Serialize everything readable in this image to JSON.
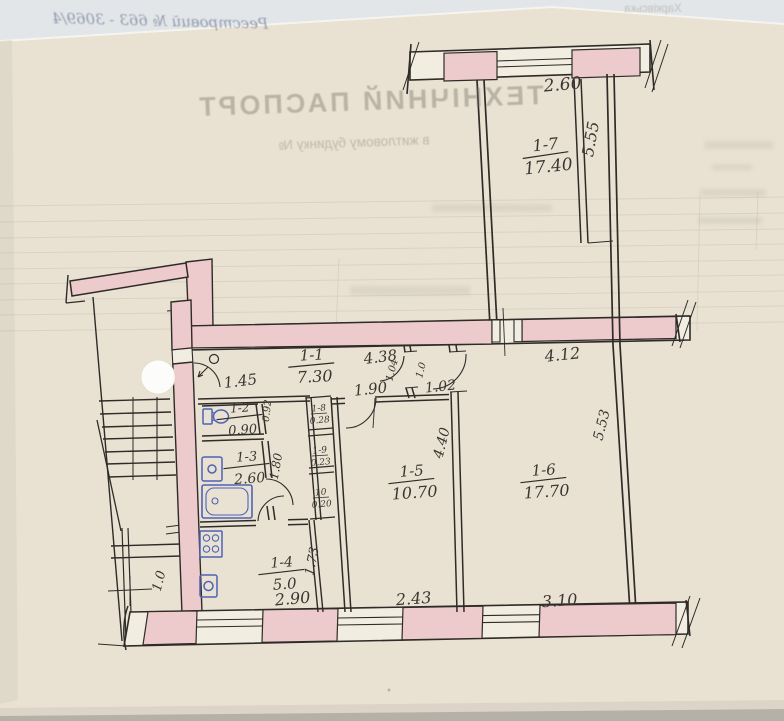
{
  "bleedthrough": {
    "registry_line": "Реєстровий № 663 - 3069/4",
    "region_note": "Харківська",
    "title": "ТЕХНІЧНИЙ ПАСПОРТ",
    "subtitle": "в житловому будинку №"
  },
  "colors": {
    "paper": "#e9e2d2",
    "photo_top_strip": "#e2e6e8",
    "photo_bottom_strip": "#b6b1a8",
    "wall_pink": "#edcacb",
    "wall_white": "#f1ede1",
    "ink": "#2e2b28",
    "plumbing_blue": "#4f63b5",
    "bleed_gray": "#a49d8f"
  },
  "plan": {
    "rooms": [
      {
        "number": "1-1",
        "area": "7.30",
        "x": 312,
        "y": 360,
        "rot": -3,
        "size": 15
      },
      {
        "number": "1-2",
        "area": "0.90",
        "x": 240,
        "y": 412,
        "rot": -4,
        "size": 12
      },
      {
        "number": "1-3",
        "area": "2.60",
        "x": 247,
        "y": 461,
        "rot": -4,
        "size": 13
      },
      {
        "number": "1-4",
        "area": "5.0",
        "x": 282,
        "y": 567,
        "rot": -4,
        "size": 14
      },
      {
        "number": "1-5",
        "area": "10.70",
        "x": 412,
        "y": 476,
        "rot": -4,
        "size": 15
      },
      {
        "number": "1-6",
        "area": "17.70",
        "x": 544,
        "y": 475,
        "rot": -4,
        "size": 15
      },
      {
        "number": "1-7",
        "area": "17.40",
        "x": 546,
        "y": 150,
        "rot": -6,
        "size": 16
      }
    ],
    "dimensions": [
      {
        "text": "2.60",
        "x": 563,
        "y": 90,
        "rot": -5,
        "size": 17
      },
      {
        "text": "5.55",
        "x": 596,
        "y": 140,
        "rot": -80,
        "size": 16
      },
      {
        "text": "4.38",
        "x": 381,
        "y": 362,
        "rot": -7,
        "size": 15
      },
      {
        "text": "4.12",
        "x": 563,
        "y": 360,
        "rot": -6,
        "size": 16
      },
      {
        "text": "1.45",
        "x": 241,
        "y": 386,
        "rot": -7,
        "size": 15
      },
      {
        "text": "1.90",
        "x": 371,
        "y": 394,
        "rot": -6,
        "size": 15
      },
      {
        "text": "1.02",
        "x": 441,
        "y": 391,
        "rot": -6,
        "size": 14
      },
      {
        "text": "1.04",
        "x": 395,
        "y": 371,
        "rot": -75,
        "size": 10
      },
      {
        "text": "1.0",
        "x": 424,
        "y": 371,
        "rot": -75,
        "size": 10
      },
      {
        "text": "0.92",
        "x": 270,
        "y": 411,
        "rot": -84,
        "size": 10
      },
      {
        "text": "1.80",
        "x": 280,
        "y": 467,
        "rot": -80,
        "size": 12
      },
      {
        "text": "4.40",
        "x": 446,
        "y": 444,
        "rot": -76,
        "size": 14
      },
      {
        "text": "5.53",
        "x": 606,
        "y": 426,
        "rot": -76,
        "size": 14
      },
      {
        "text": "1.73",
        "x": 316,
        "y": 562,
        "rot": -78,
        "size": 13
      },
      {
        "text": "1.0",
        "x": 163,
        "y": 582,
        "rot": -75,
        "size": 13
      },
      {
        "text": "2.90",
        "x": 293,
        "y": 604,
        "rot": -5,
        "size": 16
      },
      {
        "text": "2.43",
        "x": 414,
        "y": 604,
        "rot": -4,
        "size": 16
      },
      {
        "text": "3.10",
        "x": 560,
        "y": 606,
        "rot": -4,
        "size": 16
      }
    ],
    "shafts": [
      {
        "number": "1-8",
        "area": "0.28",
        "x": 319,
        "y": 411
      },
      {
        "number": "1-9",
        "area": "0.23",
        "x": 320,
        "y": 453
      },
      {
        "number": "10",
        "area": "0.20",
        "x": 321,
        "y": 495
      }
    ]
  }
}
